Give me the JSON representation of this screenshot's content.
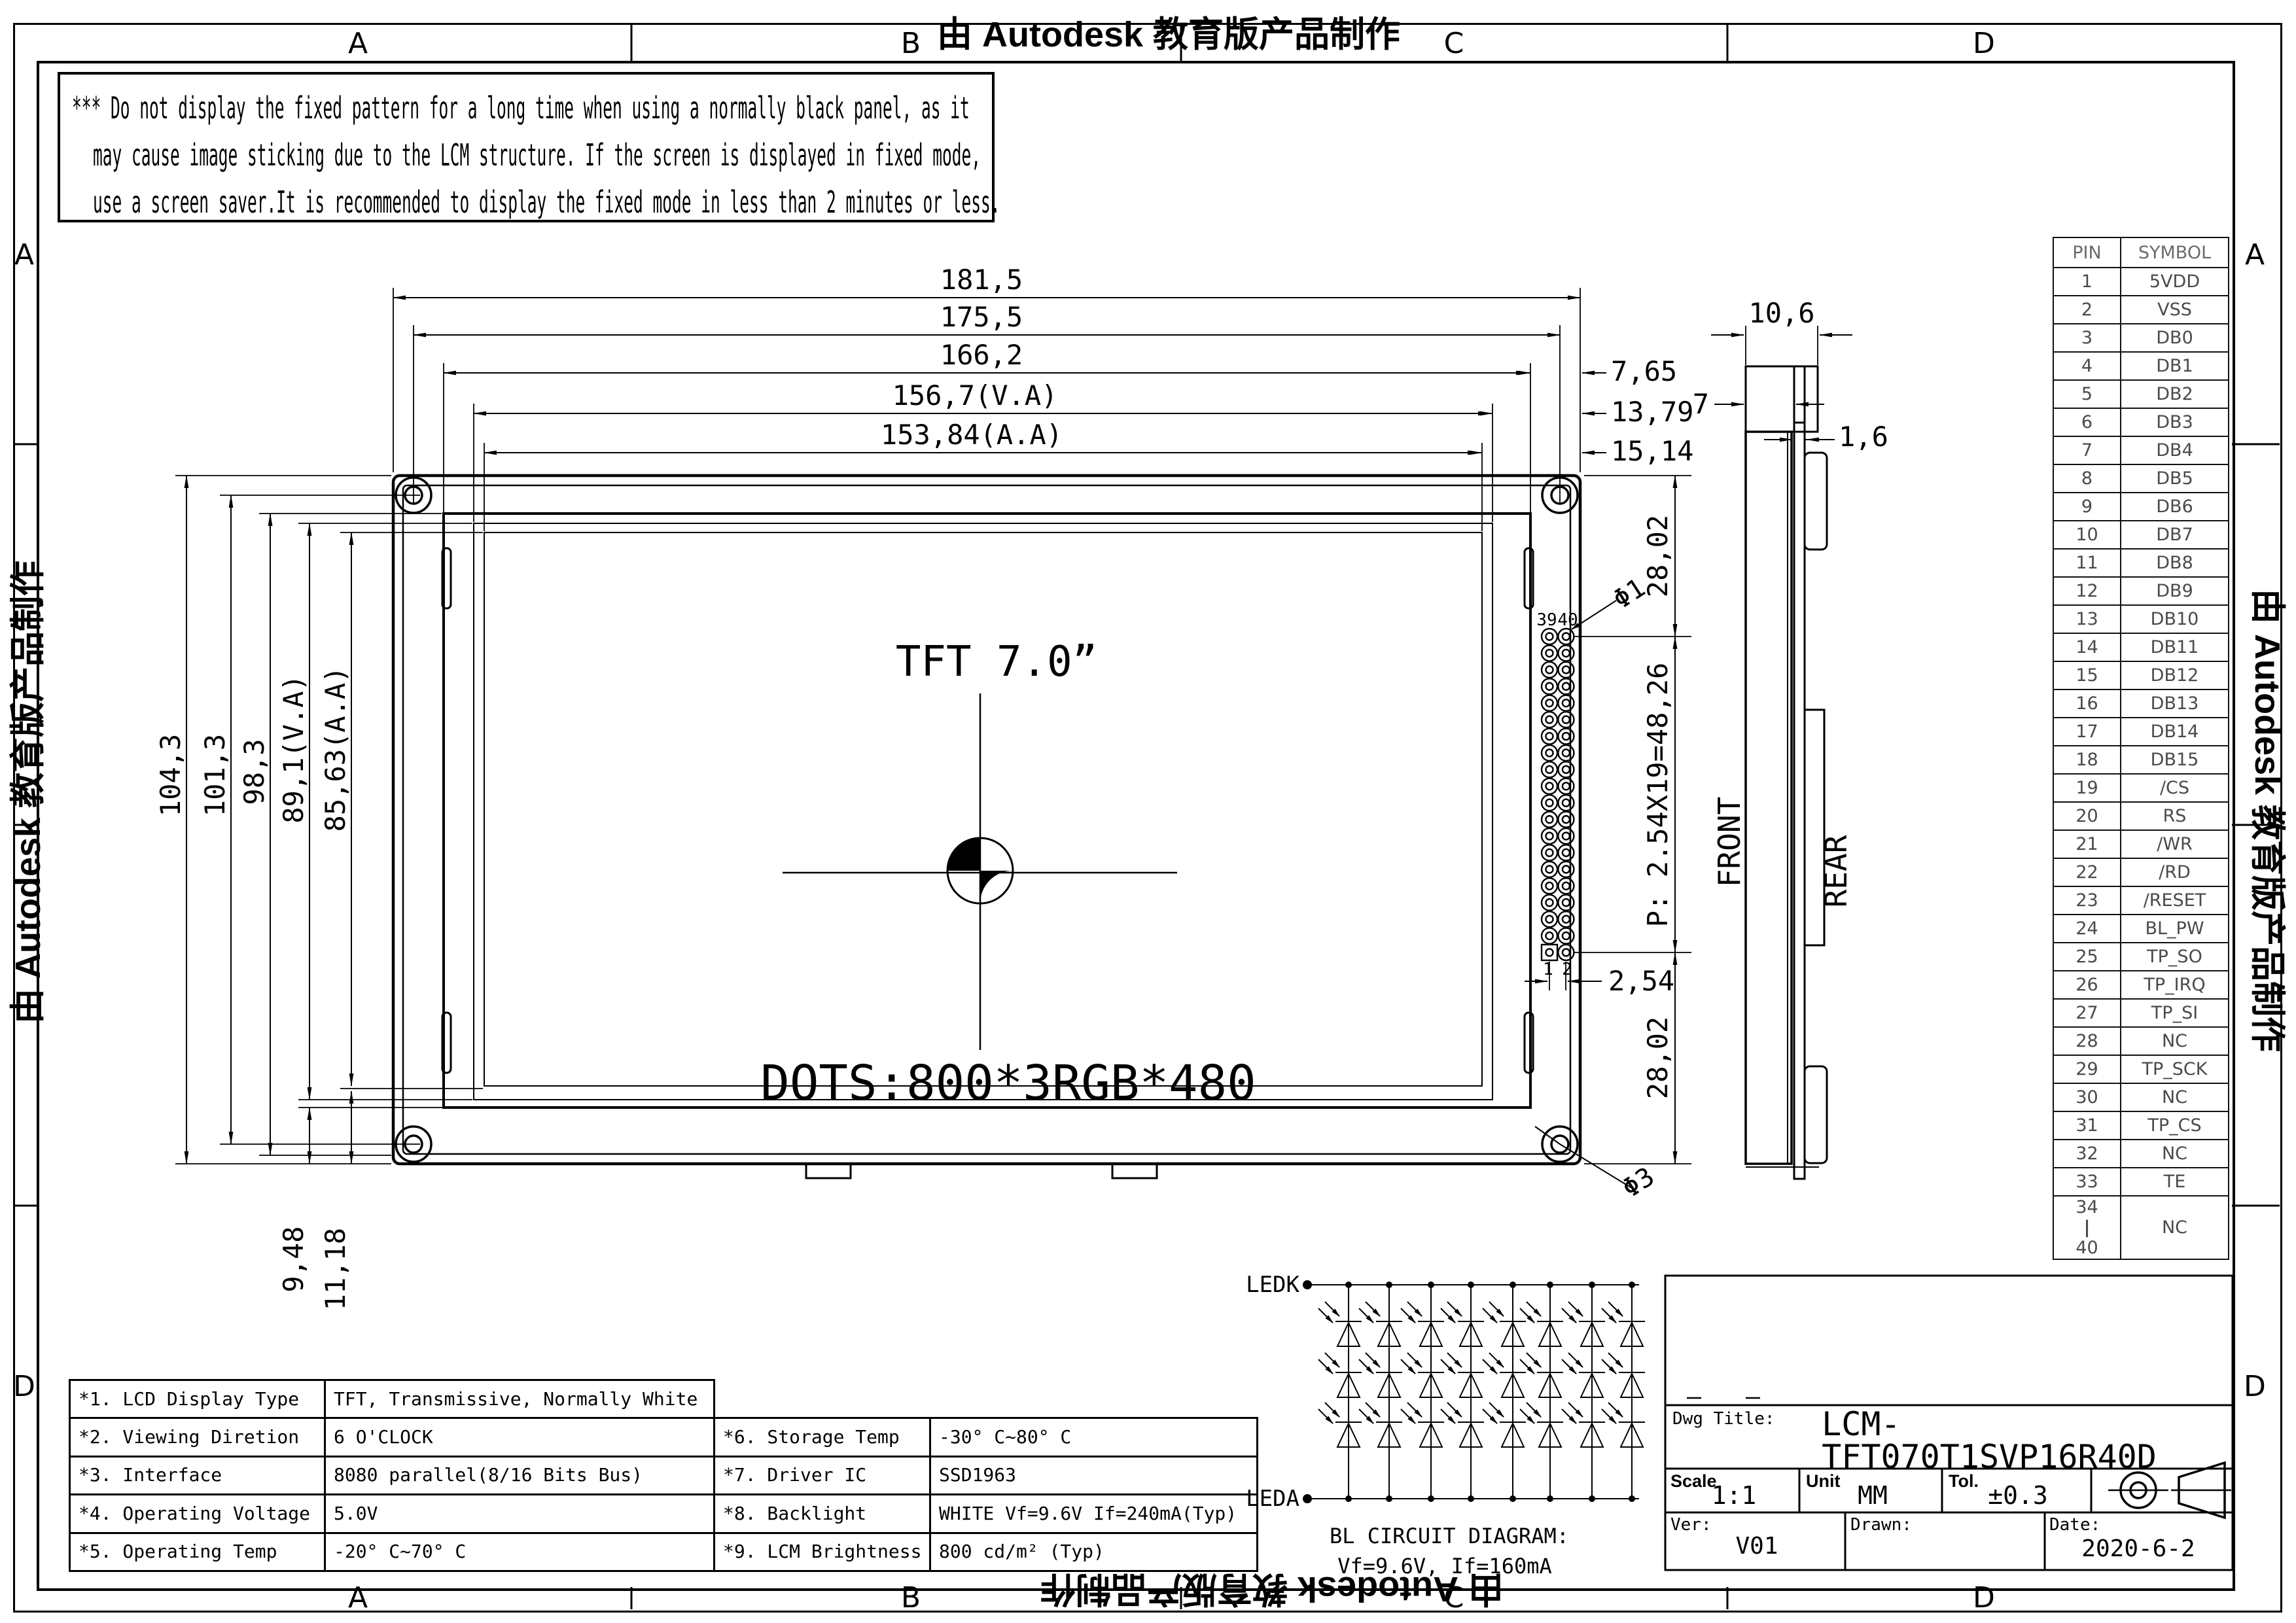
{
  "frame": {
    "watermark": "由 Autodesk 教育版产品制作",
    "zones_top": [
      "A",
      "B",
      "C",
      "D"
    ],
    "zones_bottom": [
      "A",
      "B",
      "C",
      "D"
    ],
    "zones_left": [
      "A",
      "D"
    ],
    "zones_right": [
      "A",
      "D"
    ]
  },
  "warning": {
    "line1": "*** Do not display the fixed pattern for a long time when using a normally black panel, as it",
    "line2": "may cause image sticking due to the LCM structure. If the screen is displayed in fixed mode,",
    "line3": "use a screen saver.It is recommended to display the fixed mode in less than 2 minutes or less."
  },
  "main_view": {
    "panel_label": "TFT 7.0”",
    "dots_label": "DOTS:800*3RGB*480",
    "front_label": "FRONT",
    "rear_label": "REAR"
  },
  "dims": {
    "width_total": "181,5",
    "width_holes": "175,5",
    "width_outline": "166,2",
    "width_va": "156,7(V.A)",
    "width_aa": "153,84(A.A)",
    "right_1": "7,65",
    "right_2": "13,79",
    "right_3": "15,14",
    "height_total": "104,3",
    "height_holes": "101,3",
    "height_outline": "98,3",
    "height_va": "89,1(V.A)",
    "height_aa": "85,63(A.A)",
    "bottom_1": "9,48",
    "bottom_2": "11,18",
    "conn_top": "28,02",
    "conn_pitch": "P: 2.54X19=48,26",
    "conn_bottom": "28,02",
    "pin_pitch": "2,54",
    "hole_small": "Φ1",
    "hole_mount": "Φ3",
    "side_cap": "10,6",
    "side_offset": "7",
    "side_pcb": "1,6",
    "pin39": "39",
    "pin40": "40",
    "pin1": "1",
    "pin2": "2"
  },
  "pin_table": {
    "headers": [
      "PIN",
      "SYMBOL"
    ],
    "rows": [
      {
        "p": "1",
        "s": "5VDD"
      },
      {
        "p": "2",
        "s": "VSS"
      },
      {
        "p": "3",
        "s": "DB0"
      },
      {
        "p": "4",
        "s": "DB1"
      },
      {
        "p": "5",
        "s": "DB2"
      },
      {
        "p": "6",
        "s": "DB3"
      },
      {
        "p": "7",
        "s": "DB4"
      },
      {
        "p": "8",
        "s": "DB5"
      },
      {
        "p": "9",
        "s": "DB6"
      },
      {
        "p": "10",
        "s": "DB7"
      },
      {
        "p": "11",
        "s": "DB8"
      },
      {
        "p": "12",
        "s": "DB9"
      },
      {
        "p": "13",
        "s": "DB10"
      },
      {
        "p": "14",
        "s": "DB11"
      },
      {
        "p": "15",
        "s": "DB12"
      },
      {
        "p": "16",
        "s": "DB13"
      },
      {
        "p": "17",
        "s": "DB14"
      },
      {
        "p": "18",
        "s": "DB15"
      },
      {
        "p": "19",
        "s": "/CS"
      },
      {
        "p": "20",
        "s": "RS"
      },
      {
        "p": "21",
        "s": "/WR"
      },
      {
        "p": "22",
        "s": "/RD"
      },
      {
        "p": "23",
        "s": "/RESET"
      },
      {
        "p": "24",
        "s": "BL_PW"
      },
      {
        "p": "25",
        "s": "TP_SO"
      },
      {
        "p": "26",
        "s": "TP_IRQ"
      },
      {
        "p": "27",
        "s": "TP_SI"
      },
      {
        "p": "28",
        "s": "NC"
      },
      {
        "p": "29",
        "s": "TP_SCK"
      },
      {
        "p": "30",
        "s": "NC"
      },
      {
        "p": "31",
        "s": "TP_CS"
      },
      {
        "p": "32",
        "s": "NC"
      },
      {
        "p": "33",
        "s": "TE"
      }
    ],
    "merged_row": {
      "pin_top": "34",
      "pin_bottom": "40",
      "symbol": "NC"
    }
  },
  "specs_left": [
    {
      "label": "*1. LCD Display Type",
      "value": "TFT, Transmissive, Normally White"
    },
    {
      "label": "*2. Viewing Diretion",
      "value": "6 O'CLOCK"
    },
    {
      "label": "*3. Interface",
      "value": "8080 parallel(8/16 Bits Bus)"
    },
    {
      "label": "*4. Operating Voltage",
      "value": "5.0V"
    },
    {
      "label": "*5. Operating Temp",
      "value": "-20° C~70° C"
    }
  ],
  "specs_right": [
    {
      "label": "*6. Storage Temp",
      "value": "-30° C~80° C"
    },
    {
      "label": "*7. Driver IC",
      "value": "SSD1963"
    },
    {
      "label": "*8. Backlight",
      "value": "WHITE Vf=9.6V If=240mA(Typ)"
    },
    {
      "label": "*9. LCM Brightness",
      "value": "800 cd/m² (Typ)"
    }
  ],
  "bl_circuit": {
    "cathode_label": "LEDK",
    "anode_label": "LEDA",
    "caption": "BL CIRCUIT DIAGRAM:",
    "spec": "Vf=9.6V, If=160mA"
  },
  "title_block": {
    "dwg_title_label": "Dwg Title:",
    "title": "LCM-TFT070T1SVP16R40D",
    "scale_label": "Scale",
    "scale": "1:1",
    "unit_label": "Unit",
    "unit": "MM",
    "tol_label": "Tol.",
    "tol": "±0.3",
    "ver_label": "Ver:",
    "ver": "V01",
    "drawn_label": "Drawn:",
    "drawn": "",
    "date_label": "Date:",
    "date": "2020-6-2"
  }
}
